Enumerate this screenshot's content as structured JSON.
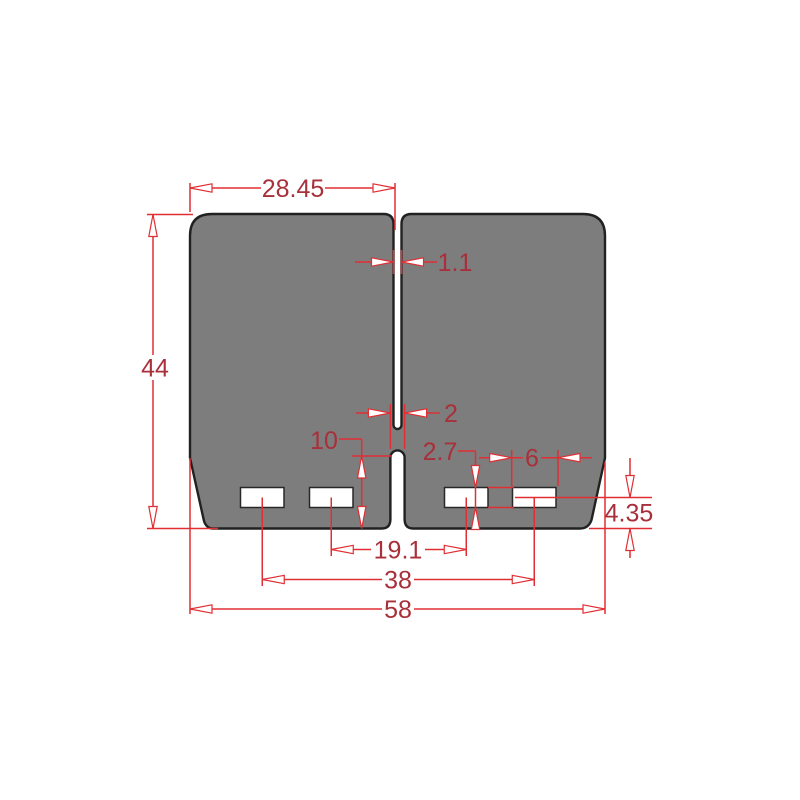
{
  "drawing": {
    "kind": "technical-dimension-drawing",
    "subject": "dual reed-valve petal plate, front view",
    "units_hint": "mm",
    "colors": {
      "background": "#ffffff",
      "petal_fill": "#7d7d7d",
      "petal_outline": "#212121",
      "port_fill": "#ffffff",
      "dimension_line": "#e02f34",
      "dimension_text": "#a8303a"
    },
    "dimensions": {
      "petal_width": "28.45",
      "top_slit_width": "1.1",
      "overall_height": "44",
      "bottom_slot_width": "2",
      "bottom_slot_length": "10",
      "port_height": "2.7",
      "port_width": "6",
      "port_center_to_bottom_edge": "4.35",
      "inner_port_spacing": "19.1",
      "outer_port_spacing": "38",
      "overall_width": "58"
    }
  }
}
